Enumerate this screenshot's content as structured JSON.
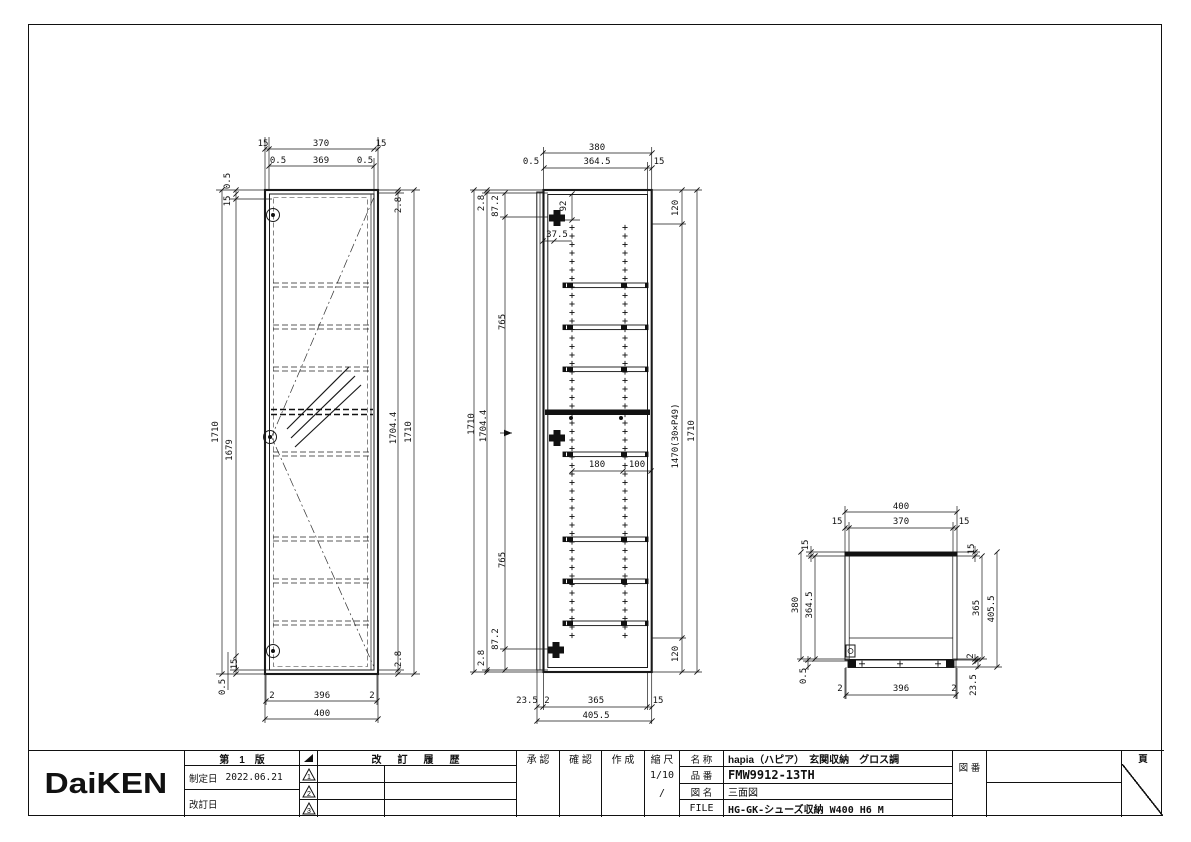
{
  "sheet": {
    "background": "#ffffff",
    "line_color": "#1a1a1a"
  },
  "title_block": {
    "logo": "DaiKEN",
    "edition": "第　1　版",
    "established_label": "制定日",
    "established_date": "2022.06.21",
    "revised_label": "改訂日",
    "history_title": "改　訂　履　歴",
    "rev_marks": [
      "1",
      "2",
      "3"
    ],
    "approved_label": "承 認",
    "checked_label": "確 認",
    "created_label": "作 成",
    "scale_label": "縮 尺",
    "scale_value": "1/10",
    "scale_extra": "/",
    "name_label": "名 称",
    "name_value": "hapia（ハピア）　玄関収納　グロス調",
    "part_label": "品 番",
    "part_value": "FMW9912-13TH",
    "figname_label": "図 名",
    "figname_value": "三面図",
    "file_label": "FILE",
    "file_value": "HG-GK-シューズ収納 W400 H6 M",
    "figno_label": "図 番",
    "page_label": "頁"
  },
  "drawing": {
    "views": [
      "front-view",
      "side-section-view",
      "top-view"
    ],
    "labels": [
      [
        "15",
        263,
        146
      ],
      [
        "370",
        321,
        146
      ],
      [
        "15",
        381,
        146
      ],
      [
        "0.5",
        278,
        163
      ],
      [
        "369",
        321,
        163
      ],
      [
        "0.5",
        365,
        163
      ],
      [
        "0.5",
        230,
        181,
        -90
      ],
      [
        "15",
        230,
        201,
        -90
      ],
      [
        "1710",
        218,
        432,
        -90
      ],
      [
        "1679",
        232,
        450,
        -90
      ],
      [
        "2.8",
        401,
        205,
        -90
      ],
      [
        "1704.4",
        396,
        428,
        -90
      ],
      [
        "1710",
        411,
        432,
        -90
      ],
      [
        "2.8",
        401,
        659,
        -90
      ],
      [
        "15",
        237,
        664,
        -90
      ],
      [
        "0.5",
        225,
        687,
        -90
      ],
      [
        "2",
        272,
        698
      ],
      [
        "396",
        322,
        698
      ],
      [
        "2",
        372,
        698
      ],
      [
        "400",
        322,
        716
      ],
      [
        "380",
        597,
        150
      ],
      [
        "0.5",
        531,
        164
      ],
      [
        "364.5",
        597,
        164
      ],
      [
        "15",
        659,
        164
      ],
      [
        "92",
        566,
        206,
        -90
      ],
      [
        "37.5",
        557,
        237
      ],
      [
        "120",
        678,
        208,
        -90
      ],
      [
        "120",
        678,
        654,
        -90
      ],
      [
        "2.8",
        484,
        203,
        -90
      ],
      [
        "87.2",
        498,
        206,
        -90
      ],
      [
        "765",
        505,
        322,
        -90
      ],
      [
        "1710",
        474,
        424,
        -90
      ],
      [
        "1704.4",
        486,
        426,
        -90
      ],
      [
        "765",
        505,
        560,
        -90
      ],
      [
        "87.2",
        498,
        639,
        -90
      ],
      [
        "2.8",
        484,
        658,
        -90
      ],
      [
        "1470(30×P49)",
        678,
        436,
        -90
      ],
      [
        "1710",
        694,
        431,
        -90
      ],
      [
        "180",
        597,
        467
      ],
      [
        "100",
        637,
        467
      ],
      [
        "23.5",
        527,
        703
      ],
      [
        "2",
        547,
        703
      ],
      [
        "365",
        596,
        703
      ],
      [
        "15",
        658,
        703
      ],
      [
        "405.5",
        596,
        718
      ],
      [
        "400",
        901,
        509
      ],
      [
        "15",
        837,
        524
      ],
      [
        "370",
        901,
        524
      ],
      [
        "15",
        964,
        524
      ],
      [
        "15",
        808,
        545,
        -90
      ],
      [
        "15",
        974,
        549,
        -90
      ],
      [
        "380",
        798,
        605,
        -90
      ],
      [
        "364.5",
        812,
        605,
        -90
      ],
      [
        "0.5",
        806,
        676,
        -90
      ],
      [
        "365",
        979,
        608,
        -90
      ],
      [
        "405.5",
        994,
        609,
        -90
      ],
      [
        "2",
        973,
        656,
        -90
      ],
      [
        "23.5",
        976,
        685,
        -90
      ],
      [
        "2",
        840,
        691
      ],
      [
        "396",
        901,
        691
      ],
      [
        "2",
        954,
        691
      ]
    ]
  }
}
